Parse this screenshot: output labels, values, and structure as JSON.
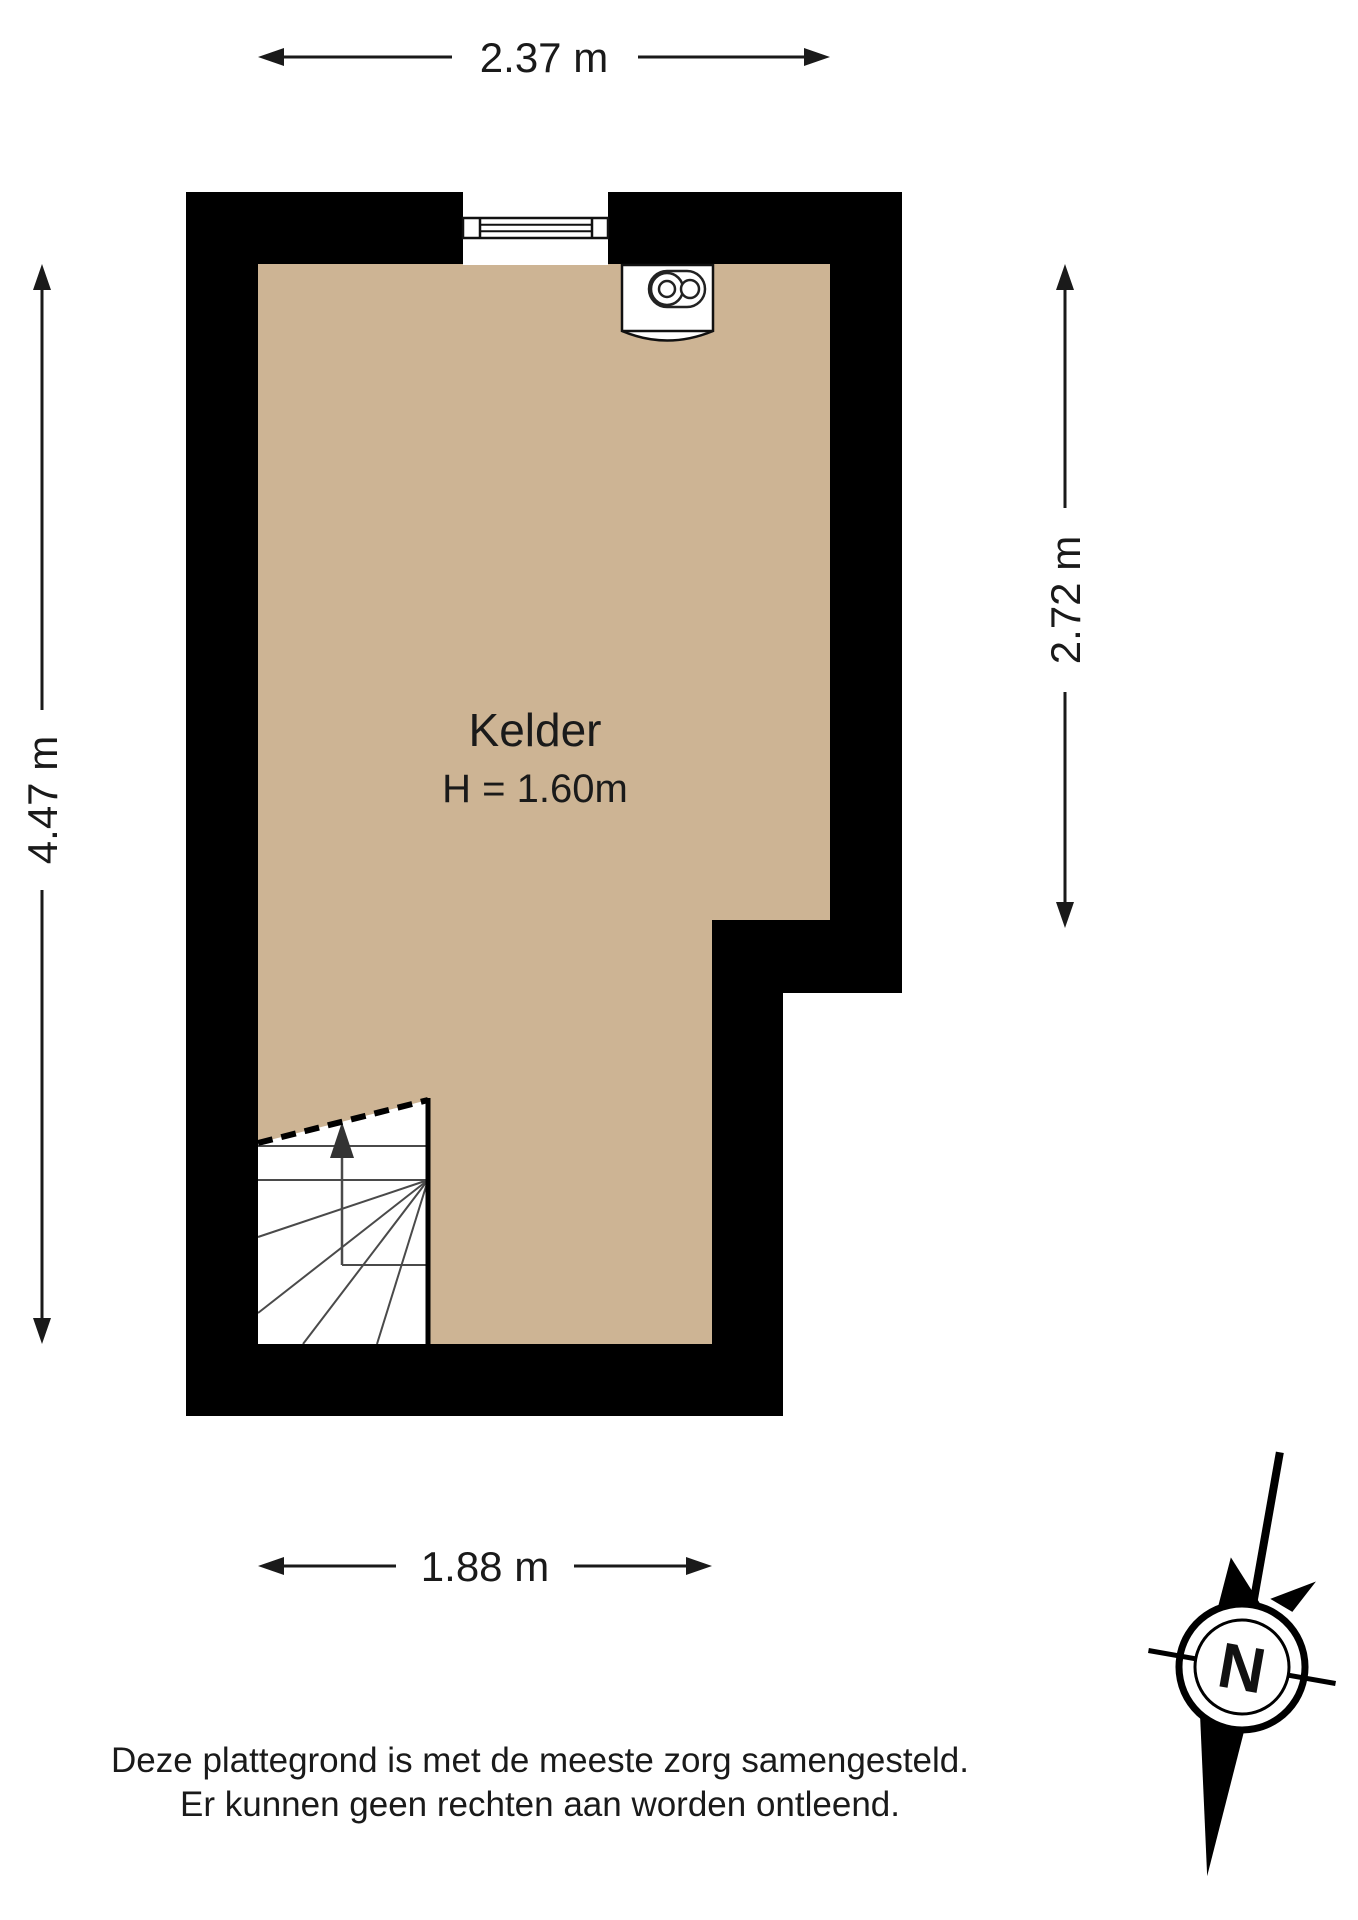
{
  "room": {
    "name": "Kelder",
    "height_label": "H = 1.60m"
  },
  "dimensions": {
    "top": "2.37 m",
    "left": "4.47 m",
    "right": "2.72 m",
    "bottom": "1.88 m"
  },
  "compass": {
    "north": "N"
  },
  "disclaimer": {
    "line1": "Deze plattegrond is met de meeste zorg samengesteld.",
    "line2": "Er kunnen geen rechten aan worden ontleend."
  },
  "colors": {
    "background": "#ffffff",
    "floor": "#cdb494",
    "wall": "#000000",
    "line": "#1a1a1a",
    "stairline": "#4a4a4a"
  }
}
